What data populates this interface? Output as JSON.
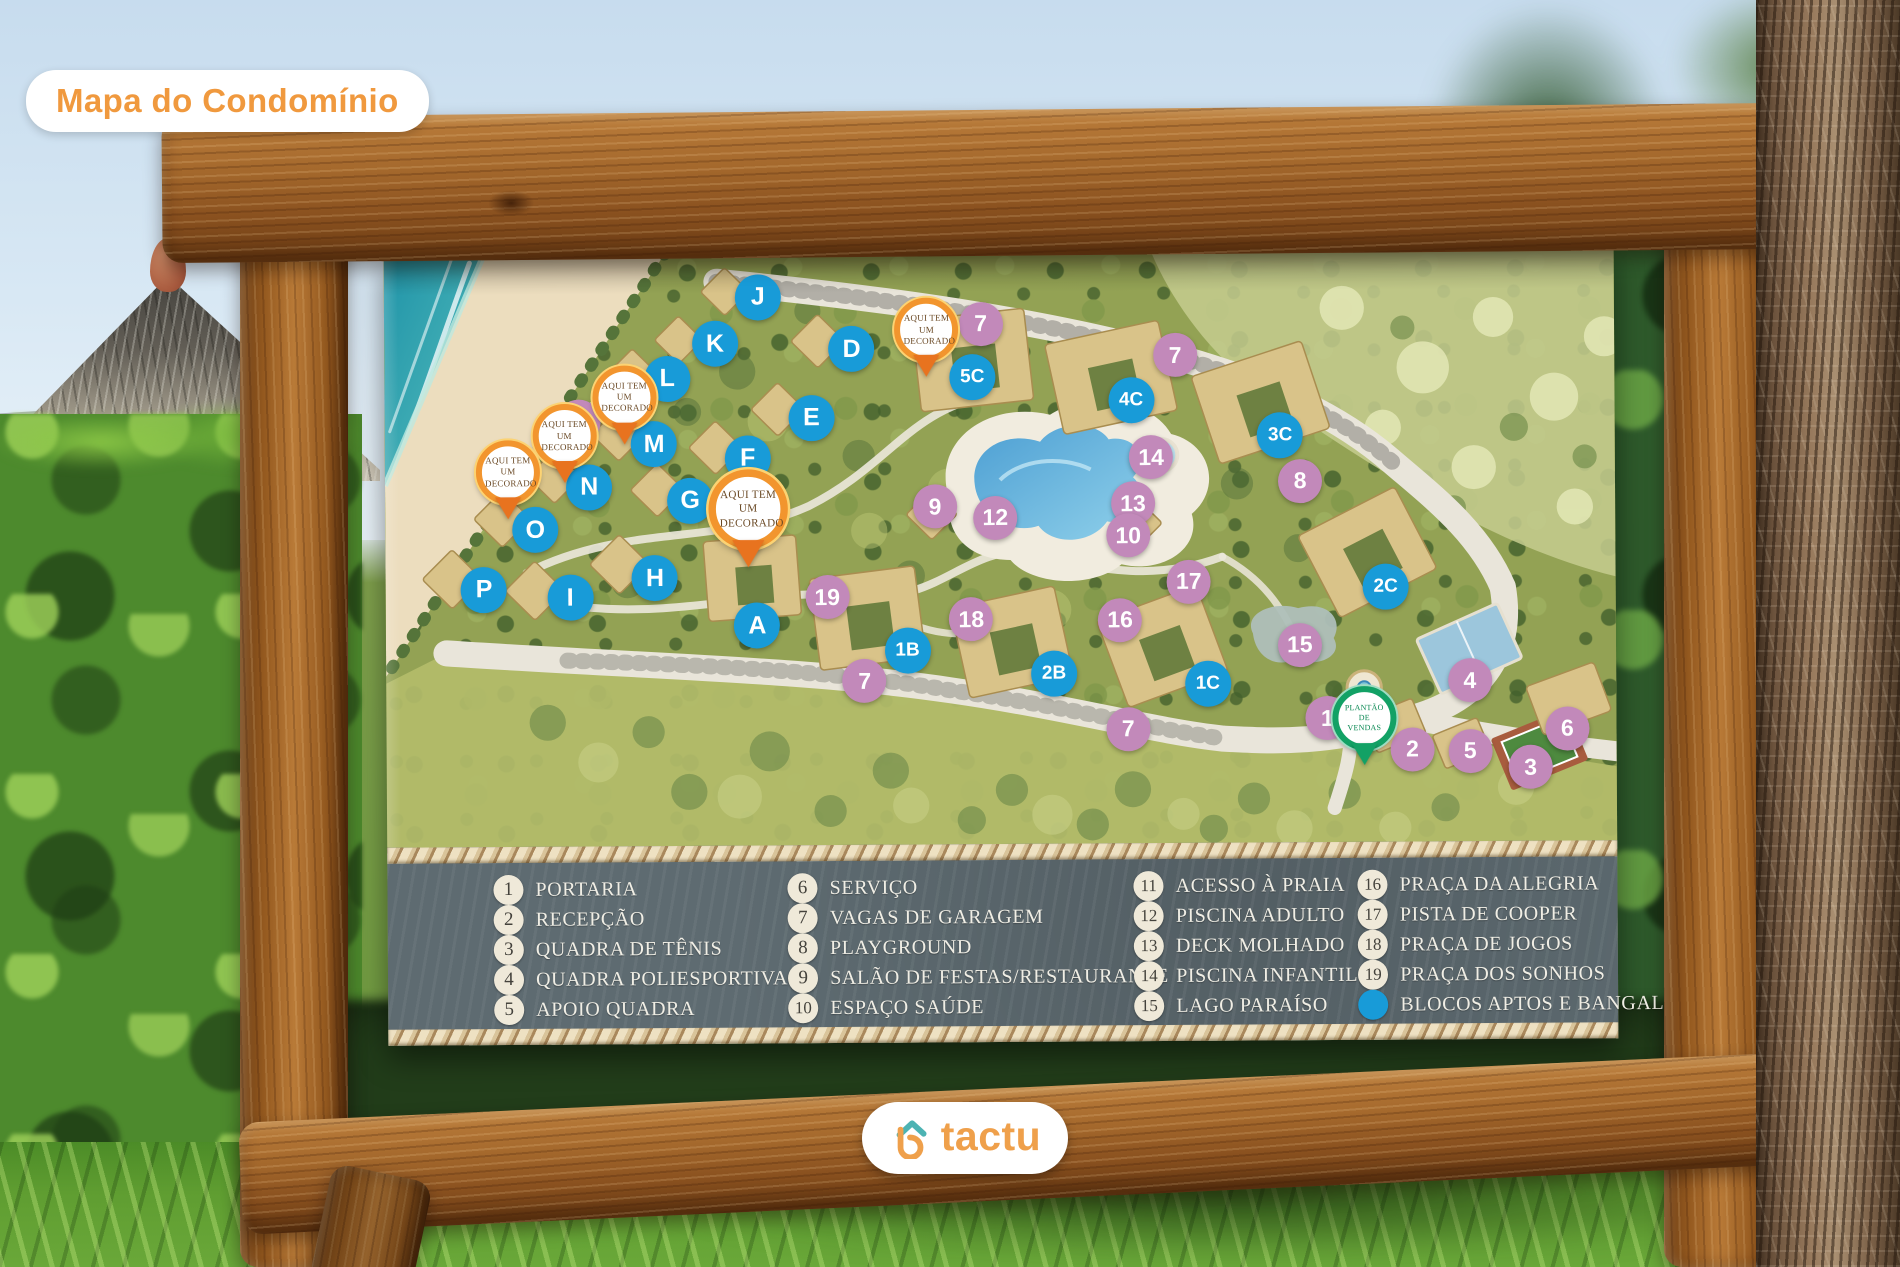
{
  "photo": {
    "badge": "Mapa do Condomínio"
  },
  "brand": {
    "name": "tactu"
  },
  "colors": {
    "accent_orange": "#F09D44",
    "brand_teal": "#4DB3B3",
    "marker_blue": "#189BD8",
    "marker_purple": "#C289BA",
    "pin_orange": "#E8731F",
    "pin_green": "#12A165",
    "legend_bg": "#5E6B71",
    "legend_circle": "#EFE9D9"
  },
  "map": {
    "decorado_label": "AQUI TEM UM DECORADO",
    "sales_label": "PLANTÃO DE VENDAS",
    "blue_markers": [
      {
        "label": "J",
        "x": 30.4,
        "y": 7.7
      },
      {
        "label": "K",
        "x": 26.9,
        "y": 15.5
      },
      {
        "label": "L",
        "x": 23.0,
        "y": 21.3
      },
      {
        "label": "M",
        "x": 21.9,
        "y": 32.4
      },
      {
        "label": "N",
        "x": 16.6,
        "y": 39.5
      },
      {
        "label": "O",
        "x": 12.2,
        "y": 46.7
      },
      {
        "label": "P",
        "x": 8.0,
        "y": 56.7
      },
      {
        "label": "I",
        "x": 15.0,
        "y": 58.1
      },
      {
        "label": "H",
        "x": 21.9,
        "y": 54.9
      },
      {
        "label": "A",
        "x": 30.2,
        "y": 63.0
      },
      {
        "label": "D",
        "x": 38.0,
        "y": 16.5
      },
      {
        "label": "E",
        "x": 34.7,
        "y": 28.1
      },
      {
        "label": "F",
        "x": 29.5,
        "y": 34.8
      },
      {
        "label": "G",
        "x": 24.8,
        "y": 41.9
      },
      {
        "label": "5C",
        "x": 47.8,
        "y": 21.3
      },
      {
        "label": "4C",
        "x": 60.7,
        "y": 25.4
      },
      {
        "label": "3C",
        "x": 72.8,
        "y": 31.5
      },
      {
        "label": "2C",
        "x": 81.3,
        "y": 57.1
      },
      {
        "label": "1C",
        "x": 66.8,
        "y": 73.3
      },
      {
        "label": "2B",
        "x": 54.3,
        "y": 71.4
      },
      {
        "label": "1B",
        "x": 42.4,
        "y": 67.3
      }
    ],
    "purple_markers": [
      {
        "label": "7",
        "x": 48.5,
        "y": 12.4
      },
      {
        "label": "7",
        "x": 64.3,
        "y": 17.9
      },
      {
        "label": "11",
        "x": 15.8,
        "y": 28.4
      },
      {
        "label": "14",
        "x": 62.3,
        "y": 35.1
      },
      {
        "label": "8",
        "x": 74.4,
        "y": 39.2
      },
      {
        "label": "9",
        "x": 44.7,
        "y": 43.1
      },
      {
        "label": "12",
        "x": 49.6,
        "y": 45.1
      },
      {
        "label": "13",
        "x": 60.8,
        "y": 42.8
      },
      {
        "label": "10",
        "x": 60.4,
        "y": 48.2
      },
      {
        "label": "17",
        "x": 65.3,
        "y": 56.0
      },
      {
        "label": "16",
        "x": 59.7,
        "y": 62.4
      },
      {
        "label": "18",
        "x": 47.6,
        "y": 62.2
      },
      {
        "label": "19",
        "x": 35.9,
        "y": 58.3
      },
      {
        "label": "15",
        "x": 74.3,
        "y": 66.8
      },
      {
        "label": "7",
        "x": 38.9,
        "y": 72.4
      },
      {
        "label": "7",
        "x": 60.3,
        "y": 80.8
      },
      {
        "label": "1",
        "x": 76.5,
        "y": 79.2
      },
      {
        "label": "2",
        "x": 83.4,
        "y": 84.5
      },
      {
        "label": "5",
        "x": 88.1,
        "y": 84.8
      },
      {
        "label": "4",
        "x": 88.1,
        "y": 72.9
      },
      {
        "label": "3",
        "x": 93.0,
        "y": 87.6
      },
      {
        "label": "6",
        "x": 96.0,
        "y": 81.1
      }
    ],
    "decorado_pins": [
      {
        "x": 19.5,
        "y": 26.2,
        "big": false
      },
      {
        "x": 14.6,
        "y": 32.7,
        "big": false
      },
      {
        "x": 10.0,
        "y": 38.7,
        "big": false
      },
      {
        "x": 29.5,
        "y": 45.5,
        "big": true
      },
      {
        "x": 44.1,
        "y": 15.2,
        "big": false
      }
    ],
    "sales_pin": {
      "x": 79.5,
      "y": 80.9
    }
  },
  "legend": {
    "columns": [
      [
        {
          "num": "1",
          "label": "PORTARIA"
        },
        {
          "num": "2",
          "label": "RECEPÇÃO"
        },
        {
          "num": "3",
          "label": "QUADRA DE TÊNIS"
        },
        {
          "num": "4",
          "label": "QUADRA POLIESPORTIVA"
        },
        {
          "num": "5",
          "label": "APOIO QUADRA"
        }
      ],
      [
        {
          "num": "6",
          "label": "SERVIÇO"
        },
        {
          "num": "7",
          "label": "VAGAS DE GARAGEM"
        },
        {
          "num": "8",
          "label": "PLAYGROUND"
        },
        {
          "num": "9",
          "label": "SALÃO DE FESTAS/RESTAURANTE"
        },
        {
          "num": "10",
          "label": "ESPAÇO SAÚDE"
        }
      ],
      [
        {
          "num": "11",
          "label": "ACESSO À PRAIA"
        },
        {
          "num": "12",
          "label": "PISCINA ADULTO"
        },
        {
          "num": "13",
          "label": "DECK MOLHADO"
        },
        {
          "num": "14",
          "label": "PISCINA INFANTIL"
        },
        {
          "num": "15",
          "label": "LAGO PARAÍSO"
        }
      ],
      [
        {
          "num": "16",
          "label": "PRAÇA DA ALEGRIA"
        },
        {
          "num": "17",
          "label": "PISTA DE COOPER"
        },
        {
          "num": "18",
          "label": "PRAÇA DE JOGOS"
        },
        {
          "num": "19",
          "label": "PRAÇA DOS SONHOS"
        },
        {
          "dot": true,
          "label": "BLOCOS APTOS E BANGALÔS"
        }
      ]
    ]
  }
}
